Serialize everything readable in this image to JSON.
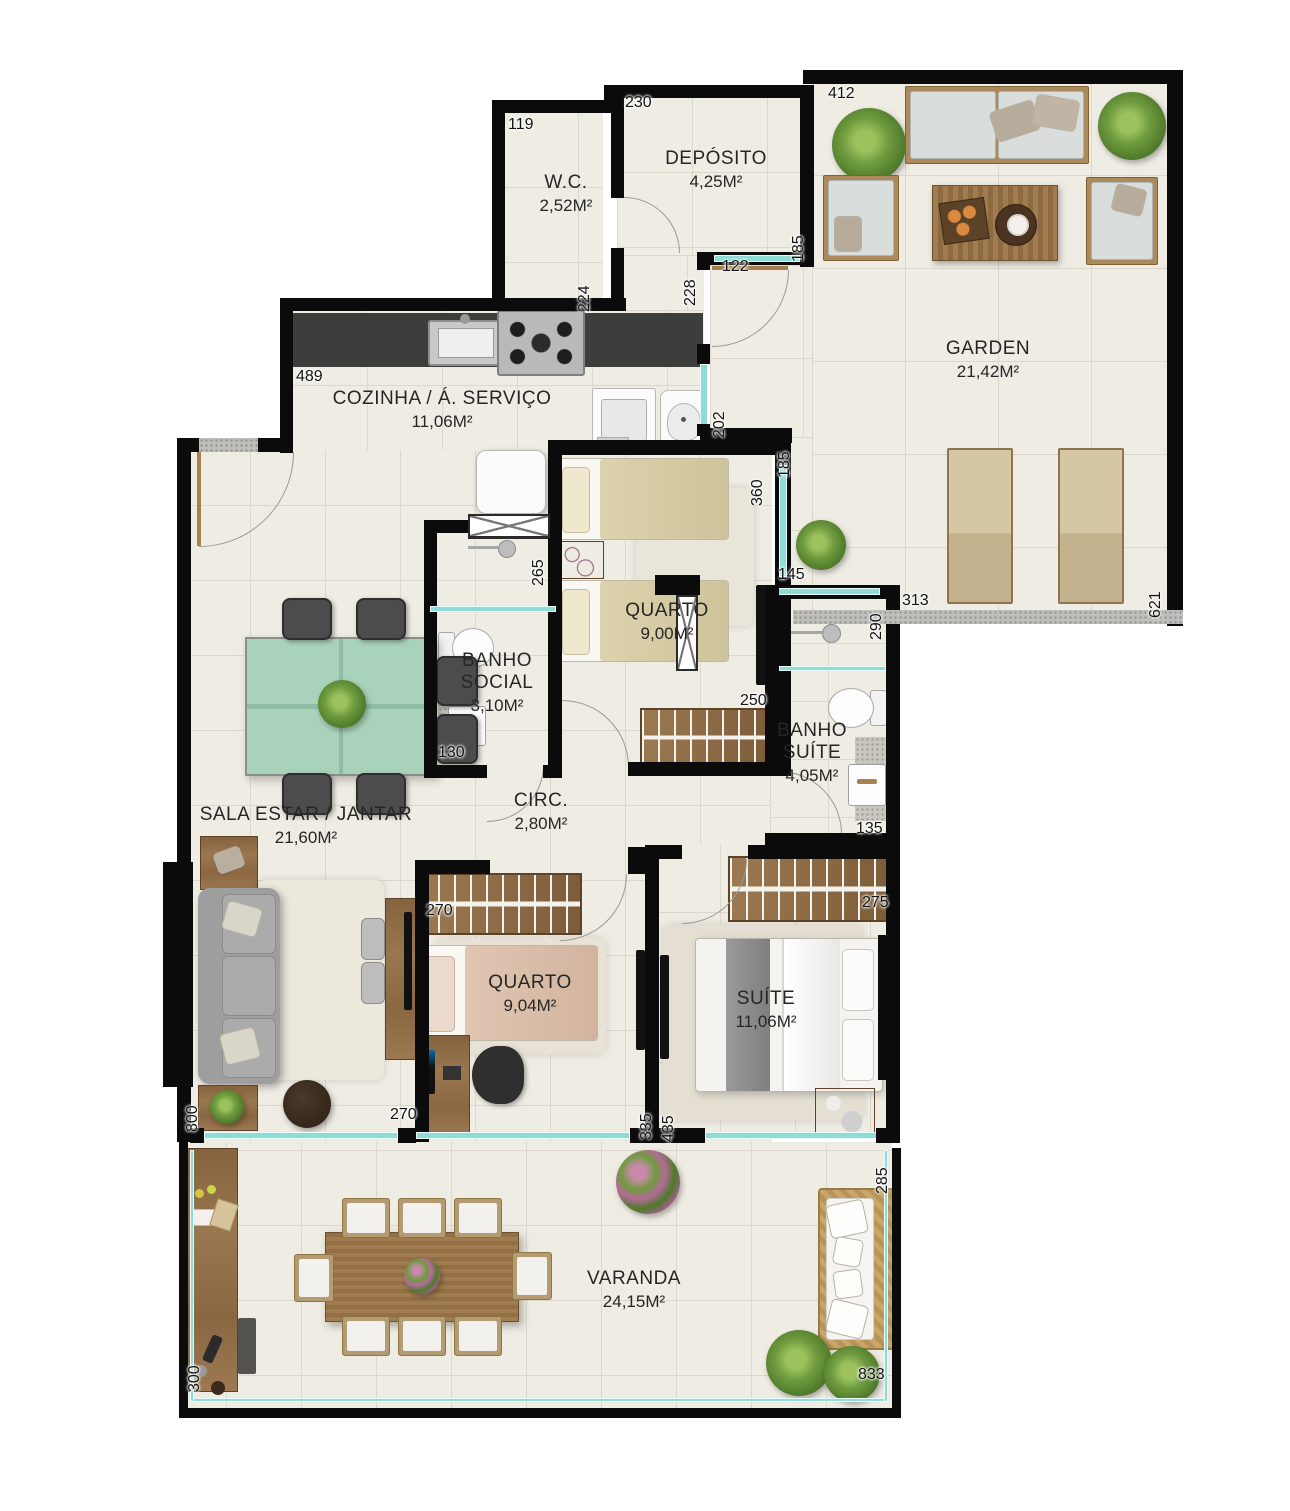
{
  "plan_title": "Apartment floor plan",
  "palette": {
    "wall": "#0B0B0B",
    "floor_tile": "#EFECE3",
    "tile_grout": "#DBD7CC",
    "glass_window": "#8FDBD5",
    "counter_granite": "#3B3E3A",
    "wood": "#8A6844",
    "dining_glass_table": "#A9D2BB"
  },
  "rooms": [
    {
      "id": "wc",
      "name": "W.C.",
      "area": "2,52M²"
    },
    {
      "id": "deposito",
      "name": "DEPÓSITO",
      "area": "4,25M²"
    },
    {
      "id": "garden",
      "name": "GARDEN",
      "area": "21,42M²"
    },
    {
      "id": "cozinha",
      "name": "COZINHA / Á. SERVIÇO",
      "area": "11,06M²"
    },
    {
      "id": "quarto1",
      "name": "QUARTO",
      "area": "9,00M²"
    },
    {
      "id": "banho_social",
      "name": "BANHO SOCIAL",
      "area": "3,10M²"
    },
    {
      "id": "banho_suite",
      "name": "BANHO SUÍTE",
      "area": "4,05M²"
    },
    {
      "id": "sala",
      "name": "SALA ESTAR / JANTAR",
      "area": "21,60M²"
    },
    {
      "id": "circ",
      "name": "CIRC.",
      "area": "2,80M²"
    },
    {
      "id": "quarto2",
      "name": "QUARTO",
      "area": "9,04M²"
    },
    {
      "id": "suite",
      "name": "SUÍTE",
      "area": "11,06M²"
    },
    {
      "id": "varanda",
      "name": "VARANDA",
      "area": "24,15M²"
    }
  ],
  "dimensions": [
    {
      "text": "119"
    },
    {
      "text": "230"
    },
    {
      "text": "412"
    },
    {
      "text": "185"
    },
    {
      "text": "228"
    },
    {
      "text": "122"
    },
    {
      "text": "224"
    },
    {
      "text": "489"
    },
    {
      "text": "202"
    },
    {
      "text": "185"
    },
    {
      "text": "360"
    },
    {
      "text": "145"
    },
    {
      "text": "290"
    },
    {
      "text": "313"
    },
    {
      "text": "621"
    },
    {
      "text": "265"
    },
    {
      "text": "130"
    },
    {
      "text": "250"
    },
    {
      "text": "135"
    },
    {
      "text": "270"
    },
    {
      "text": "275"
    },
    {
      "text": "800"
    },
    {
      "text": "270"
    },
    {
      "text": "335"
    },
    {
      "text": "435"
    },
    {
      "text": "285"
    },
    {
      "text": "833"
    },
    {
      "text": "300"
    }
  ]
}
